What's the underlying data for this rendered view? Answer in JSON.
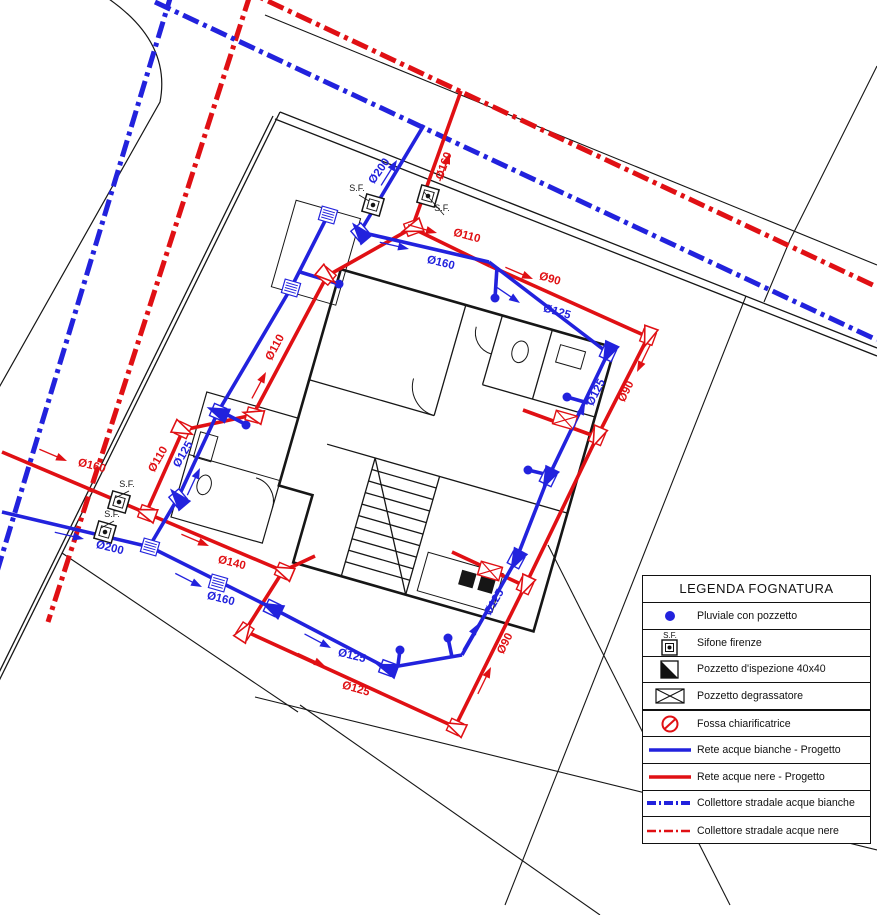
{
  "colors": {
    "red": "#e01014",
    "blue": "#2222dd",
    "black": "#161616"
  },
  "legend": {
    "title": "LEGENDA FOGNATURA",
    "rows": [
      {
        "icon": "pluviale-dot-icon",
        "label": "Pluviale con pozzetto"
      },
      {
        "icon": "sifone-firenze-icon",
        "label": "Sifone firenze",
        "sf_text": "S.F."
      },
      {
        "icon": "pozzetto-ispezione-icon",
        "label": "Pozzetto d'ispezione 40x40"
      },
      {
        "icon": "pozzetto-degrassatore-icon",
        "label": "Pozzetto degrassatore"
      },
      {
        "icon": "fossa-chiarificatrice-icon",
        "label": "Fossa chiarificatrice",
        "thick": true
      },
      {
        "icon": "rete-bianche-line-icon",
        "label": "Rete acque bianche - Progetto"
      },
      {
        "icon": "rete-nere-line-icon",
        "label": "Rete acque nere - Progetto"
      },
      {
        "icon": "collettore-bianche-line-icon",
        "label": "Collettore stradale acque bianche"
      },
      {
        "icon": "collettore-nere-line-icon",
        "label": "Collettore stradale acque nere"
      }
    ]
  },
  "plan": {
    "collectors": [
      {
        "name": "collettore-bianche-left",
        "color": "blue",
        "pts": [
          [
            172,
            -8
          ],
          [
            -10,
            595
          ]
        ]
      },
      {
        "name": "collettore-nere-left",
        "color": "red",
        "pts": [
          [
            250,
            -5
          ],
          [
            48,
            622
          ]
        ]
      },
      {
        "name": "collettore-bianche-top",
        "color": "blue",
        "pts": [
          [
            155,
            2
          ],
          [
            877,
            340
          ]
        ]
      },
      {
        "name": "collettore-nere-top",
        "color": "red",
        "pts": [
          [
            240,
            -12
          ],
          [
            877,
            287
          ]
        ]
      }
    ],
    "boundaries": [
      {
        "name": "street-edge-top",
        "pts": [
          [
            265,
            15
          ],
          [
            877,
            265
          ]
        ],
        "w": 1.1
      },
      {
        "name": "lot-corner-top-right",
        "pts": [
          [
            877,
            66
          ],
          [
            790,
            240
          ],
          [
            764,
            302
          ]
        ],
        "w": 1.1
      },
      {
        "name": "lot-line-right",
        "pts": [
          [
            746,
            296
          ],
          [
            505,
            905
          ]
        ],
        "w": 1.1
      },
      {
        "name": "lot-line-right-2",
        "pts": [
          [
            548,
            545
          ],
          [
            730,
            905
          ]
        ],
        "w": 1.1
      },
      {
        "name": "lot-line-bottom-1",
        "pts": [
          [
            62,
            553
          ],
          [
            298,
            712
          ]
        ],
        "w": 1.1
      },
      {
        "name": "lot-line-bottom-2",
        "pts": [
          [
            255,
            697
          ],
          [
            877,
            850
          ]
        ],
        "w": 1.1
      },
      {
        "name": "lot-line-bottom-3",
        "pts": [
          [
            300,
            705
          ],
          [
            600,
            915
          ]
        ],
        "w": 1.1
      },
      {
        "name": "property-wall-top-a",
        "pts": [
          [
            280,
            112
          ],
          [
            877,
            348
          ]
        ],
        "w": 1.3
      },
      {
        "name": "property-wall-top-b",
        "pts": [
          [
            275,
            119
          ],
          [
            877,
            356
          ]
        ],
        "w": 1.3
      },
      {
        "name": "property-wall-left-a",
        "pts": [
          [
            280,
            112
          ],
          [
            -8,
            695
          ]
        ],
        "w": 1.3
      },
      {
        "name": "property-wall-left-b",
        "pts": [
          [
            273,
            116
          ],
          [
            -15,
            701
          ]
        ],
        "w": 1.3
      }
    ],
    "curb_path": "M103,-5 Q172,40 160,102 L-8,400",
    "pipes_red": [
      [
        [
          461,
          91
        ],
        [
          412,
          228
        ]
      ],
      [
        [
          412,
          228
        ],
        [
          490,
          266
        ]
      ],
      [
        [
          490,
          266
        ],
        [
          648,
          337
        ]
      ],
      [
        [
          648,
          337
        ],
        [
          597,
          437
        ]
      ],
      [
        [
          597,
          437
        ],
        [
          525,
          586
        ]
      ],
      [
        [
          525,
          586
        ],
        [
          455,
          727
        ]
      ],
      [
        [
          455,
          727
        ],
        [
          245,
          631
        ]
      ],
      [
        [
          245,
          631
        ],
        [
          283,
          571
        ]
      ],
      [
        [
          283,
          571
        ],
        [
          146,
          513
        ]
      ],
      [
        [
          146,
          513
        ],
        [
          2,
          452
        ]
      ],
      [
        [
          412,
          228
        ],
        [
          327,
          276
        ]
      ],
      [
        [
          327,
          276
        ],
        [
          253,
          415
        ]
      ],
      [
        [
          253,
          415
        ],
        [
          183,
          430
        ]
      ],
      [
        [
          183,
          430
        ],
        [
          146,
          513
        ]
      ],
      [
        [
          523,
          410
        ],
        [
          597,
          437
        ]
      ],
      [
        [
          452,
          552
        ],
        [
          525,
          586
        ]
      ],
      [
        [
          283,
          571
        ],
        [
          315,
          556
        ]
      ]
    ],
    "pipes_blue": [
      [
        [
          424,
          125
        ],
        [
          360,
          232
        ]
      ],
      [
        [
          360,
          232
        ],
        [
          489,
          262
        ]
      ],
      [
        [
          489,
          262
        ],
        [
          608,
          353
        ]
      ],
      [
        [
          608,
          353
        ],
        [
          548,
          478
        ]
      ],
      [
        [
          548,
          478
        ],
        [
          516,
          560
        ]
      ],
      [
        [
          516,
          560
        ],
        [
          462,
          655
        ]
      ],
      [
        [
          462,
          655
        ],
        [
          387,
          668
        ]
      ],
      [
        [
          387,
          668
        ],
        [
          272,
          608
        ]
      ],
      [
        [
          272,
          608
        ],
        [
          150,
          547
        ]
      ],
      [
        [
          150,
          547
        ],
        [
          2,
          512
        ]
      ],
      [
        [
          328,
          215
        ],
        [
          291,
          288
        ]
      ],
      [
        [
          291,
          288
        ],
        [
          218,
          412
        ]
      ],
      [
        [
          218,
          412
        ],
        [
          178,
          498
        ]
      ],
      [
        [
          178,
          498
        ],
        [
          152,
          542
        ]
      ],
      [
        [
          222,
          412
        ],
        [
          243,
          423
        ]
      ],
      [
        [
          567,
          397
        ],
        [
          588,
          403
        ]
      ],
      [
        [
          528,
          470
        ],
        [
          553,
          476
        ]
      ],
      [
        [
          495,
          298
        ],
        [
          497,
          267
        ]
      ],
      [
        [
          448,
          638
        ],
        [
          452,
          657
        ]
      ],
      [
        [
          400,
          650
        ],
        [
          398,
          665
        ]
      ],
      [
        [
          339,
          284
        ],
        [
          300,
          272
        ]
      ]
    ],
    "pipe_labels": [
      {
        "t": "Ø160",
        "x": 447,
        "y": 167,
        "r": -70,
        "c": "red"
      },
      {
        "t": "Ø110",
        "x": 466,
        "y": 239,
        "r": 15,
        "c": "red"
      },
      {
        "t": "Ø90",
        "x": 549,
        "y": 282,
        "r": 16,
        "c": "red"
      },
      {
        "t": "Ø90",
        "x": 629,
        "y": 393,
        "r": -63,
        "c": "red"
      },
      {
        "t": "Ø90",
        "x": 508,
        "y": 645,
        "r": -63,
        "c": "red"
      },
      {
        "t": "Ø125",
        "x": 355,
        "y": 692,
        "r": 16,
        "c": "red"
      },
      {
        "t": "Ø140",
        "x": 231,
        "y": 566,
        "r": 14,
        "c": "red"
      },
      {
        "t": "Ø160",
        "x": 91,
        "y": 469,
        "r": 14,
        "c": "red"
      },
      {
        "t": "Ø110",
        "x": 278,
        "y": 349,
        "r": -62,
        "c": "red"
      },
      {
        "t": "Ø110",
        "x": 161,
        "y": 461,
        "r": -60,
        "c": "red"
      },
      {
        "t": "Ø200",
        "x": 382,
        "y": 173,
        "r": -55,
        "c": "blue"
      },
      {
        "t": "Ø160",
        "x": 440,
        "y": 266,
        "r": 14,
        "c": "blue"
      },
      {
        "t": "Ø125",
        "x": 556,
        "y": 315,
        "r": 16,
        "c": "blue"
      },
      {
        "t": "Ø125",
        "x": 599,
        "y": 394,
        "r": -63,
        "c": "blue"
      },
      {
        "t": "Ø125",
        "x": 497,
        "y": 604,
        "r": -60,
        "c": "blue"
      },
      {
        "t": "Ø125",
        "x": 351,
        "y": 659,
        "r": 14,
        "c": "blue"
      },
      {
        "t": "Ø160",
        "x": 220,
        "y": 602,
        "r": 14,
        "c": "blue"
      },
      {
        "t": "Ø200",
        "x": 109,
        "y": 551,
        "r": 14,
        "c": "blue"
      },
      {
        "t": "Ø125",
        "x": 186,
        "y": 456,
        "r": -60,
        "c": "blue"
      }
    ],
    "sf_markers": [
      {
        "x": 373,
        "y": 205,
        "lx": 357,
        "ly": 191
      },
      {
        "x": 428,
        "y": 196,
        "lx": 442,
        "ly": 211
      },
      {
        "x": 119,
        "y": 502,
        "lx": 127,
        "ly": 487
      },
      {
        "x": 105,
        "y": 532,
        "lx": 112,
        "ly": 517
      }
    ],
    "sf_label": "S.F.",
    "grates": [
      [
        328,
        215
      ],
      [
        291,
        288
      ],
      [
        150,
        547
      ],
      [
        218,
        583
      ]
    ],
    "xboxes": [
      [
        565,
        420
      ],
      [
        490,
        571
      ]
    ],
    "dots": [
      [
        339,
        284
      ],
      [
        495,
        298
      ],
      [
        567,
        397
      ],
      [
        528,
        470
      ],
      [
        448,
        638
      ],
      [
        400,
        650
      ],
      [
        246,
        425
      ]
    ],
    "cboxes": [
      {
        "x": 412,
        "y": 228,
        "r": 160,
        "c": "red"
      },
      {
        "x": 327,
        "y": 276,
        "r": 40,
        "c": "red"
      },
      {
        "x": 253,
        "y": 415,
        "r": 195,
        "c": "red"
      },
      {
        "x": 183,
        "y": 430,
        "r": 25,
        "c": "red"
      },
      {
        "x": 648,
        "y": 337,
        "r": 110,
        "c": "red"
      },
      {
        "x": 597,
        "y": 437,
        "r": 113,
        "c": "red"
      },
      {
        "x": 525,
        "y": 586,
        "r": 115,
        "c": "red"
      },
      {
        "x": 455,
        "y": 727,
        "r": 205,
        "c": "red"
      },
      {
        "x": 245,
        "y": 631,
        "r": -57,
        "c": "red"
      },
      {
        "x": 146,
        "y": 513,
        "r": 200,
        "c": "red"
      },
      {
        "x": 283,
        "y": 571,
        "r": 203,
        "c": "red"
      },
      {
        "x": 360,
        "y": 232,
        "r": 230,
        "c": "blue"
      },
      {
        "x": 608,
        "y": 353,
        "r": 115,
        "c": "blue"
      },
      {
        "x": 548,
        "y": 478,
        "r": 116,
        "c": "blue"
      },
      {
        "x": 516,
        "y": 560,
        "r": 118,
        "c": "blue"
      },
      {
        "x": 387,
        "y": 668,
        "r": 200,
        "c": "blue"
      },
      {
        "x": 272,
        "y": 608,
        "r": 206,
        "c": "blue"
      },
      {
        "x": 218,
        "y": 412,
        "r": 203,
        "c": "blue"
      },
      {
        "x": 178,
        "y": 498,
        "r": 230,
        "c": "blue"
      }
    ],
    "arrows": [
      {
        "x": 450,
        "y": 153,
        "r": 110,
        "c": "red"
      },
      {
        "x": 437,
        "y": 233,
        "r": 196,
        "c": "red"
      },
      {
        "x": 533,
        "y": 279,
        "r": 203,
        "c": "red"
      },
      {
        "x": 637,
        "y": 372,
        "r": -64,
        "c": "red"
      },
      {
        "x": 491,
        "y": 667,
        "r": 116,
        "c": "red"
      },
      {
        "x": 325,
        "y": 666,
        "r": 205,
        "c": "red"
      },
      {
        "x": 209,
        "y": 546,
        "r": 203,
        "c": "red"
      },
      {
        "x": 67,
        "y": 461,
        "r": 203,
        "c": "red"
      },
      {
        "x": 266,
        "y": 372,
        "r": 118,
        "c": "red"
      },
      {
        "x": 397,
        "y": 160,
        "r": 122,
        "c": "blue"
      },
      {
        "x": 409,
        "y": 249,
        "r": 193,
        "c": "blue"
      },
      {
        "x": 520,
        "y": 303,
        "r": 214,
        "c": "blue"
      },
      {
        "x": 585,
        "y": 404,
        "r": 116,
        "c": "blue"
      },
      {
        "x": 478,
        "y": 624,
        "r": 120,
        "c": "blue"
      },
      {
        "x": 331,
        "y": 648,
        "r": 208,
        "c": "blue"
      },
      {
        "x": 202,
        "y": 587,
        "r": 207,
        "c": "blue"
      },
      {
        "x": 84,
        "y": 539,
        "r": 193,
        "c": "blue"
      },
      {
        "x": 200,
        "y": 468,
        "r": 115,
        "c": "blue"
      }
    ]
  }
}
